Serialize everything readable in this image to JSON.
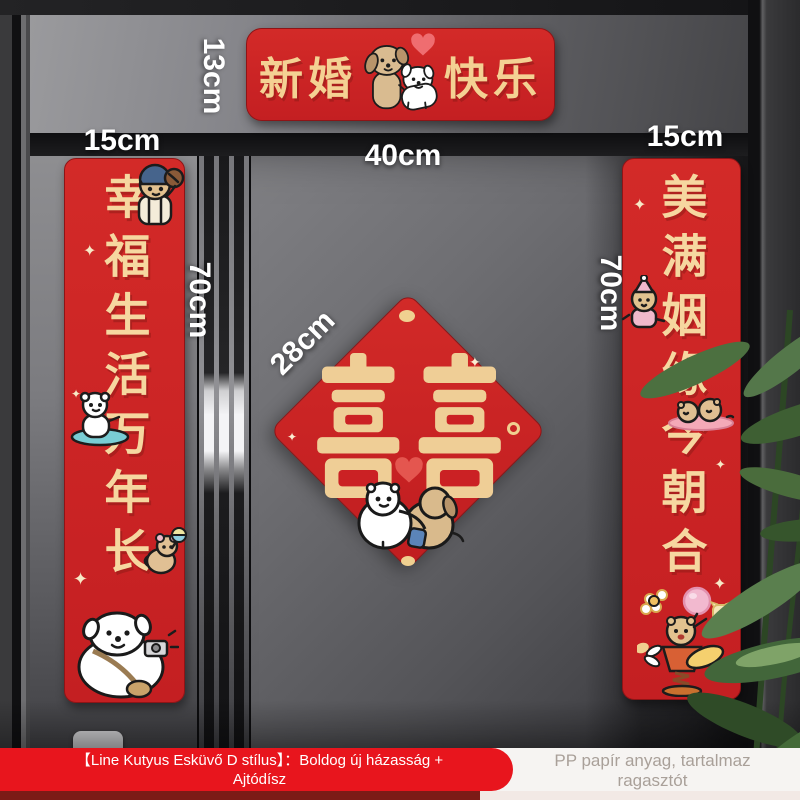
{
  "labels": {
    "banner_height": "13cm",
    "banner_width": "40cm",
    "left_couplet_width": "15cm",
    "right_couplet_width": "15cm",
    "left_couplet_height": "70cm",
    "right_couplet_height": "70cm",
    "diamond_width": "28cm"
  },
  "banner": {
    "text_left": "新婚",
    "text_right": "快乐"
  },
  "couplets": {
    "left": "幸福生活万年长",
    "right": "美满姻缘今朝合"
  },
  "diamond": {
    "character": "囍"
  },
  "footer": {
    "product_line1": "【Line Kutyus Esküvő D stílus】：Boldog új házasság +",
    "product_line2": "Ajtódísz",
    "material_line1": "PP papír anyag, tartalmaz",
    "material_line2": "ragasztót"
  },
  "deco": {
    "sparkle": "✦"
  },
  "illustrations": {
    "banner": "two-dogs-with-heart",
    "left_couplet": [
      "bear-with-cap",
      "surfing-bear",
      "mouse-with-rattle",
      "dog-with-camera"
    ],
    "right_couplet": [
      "bear-with-pink-hat",
      "lying-bears-on-mat",
      "bear-on-spring-plane"
    ],
    "diamond": "hugging-dogs"
  },
  "colors": {
    "sticker_red": "#cf2226",
    "gold_text": "#f5d8a0",
    "footer_red": "#e8151d",
    "footer_dark_red": "#7c1b16",
    "door_gray": "#77777b",
    "label_white": "#ffffff",
    "plant_green": "#42663a"
  }
}
